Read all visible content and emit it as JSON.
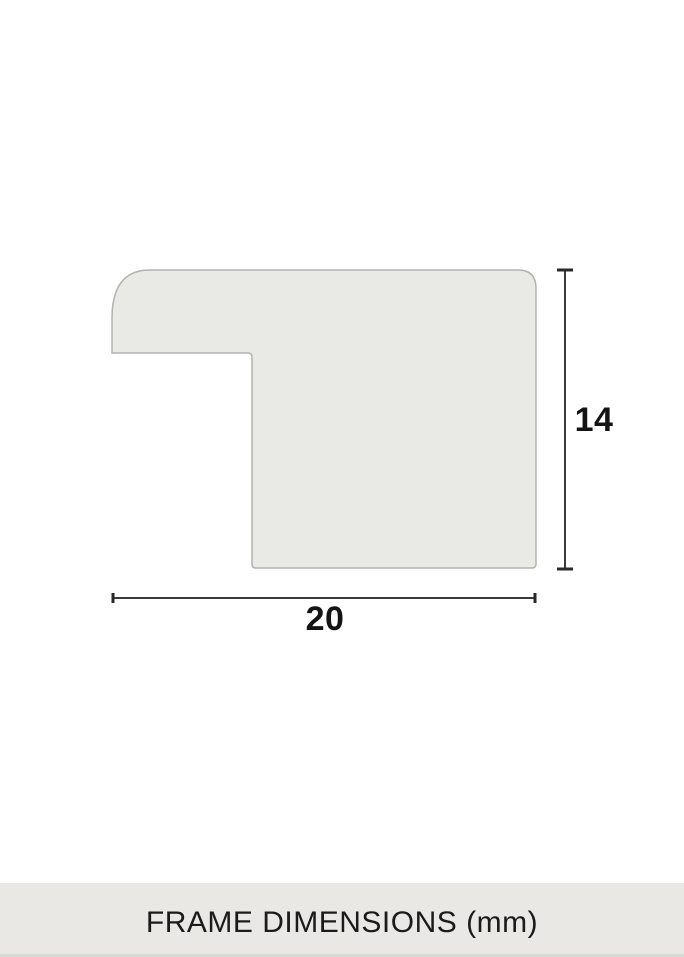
{
  "diagram": {
    "type": "frame-moulding-profile-cross-section",
    "width_dimension": {
      "value": "20"
    },
    "height_dimension": {
      "value": "14"
    }
  },
  "footer": {
    "caption": "FRAME DIMENSIONS (mm)"
  },
  "colors": {
    "background": "#ffffff",
    "shape_fill": "#e9e9e6",
    "shape_outline": "#b3b3b0",
    "dimension_line": "#3a3a3a",
    "dimension_cap": "#2a2a2a",
    "label_text": "#141414",
    "caption_bar_background": "#e9e8e4",
    "caption_bar_bottom_edge": "#d8d8d4",
    "caption_text": "#1b1b1b"
  }
}
